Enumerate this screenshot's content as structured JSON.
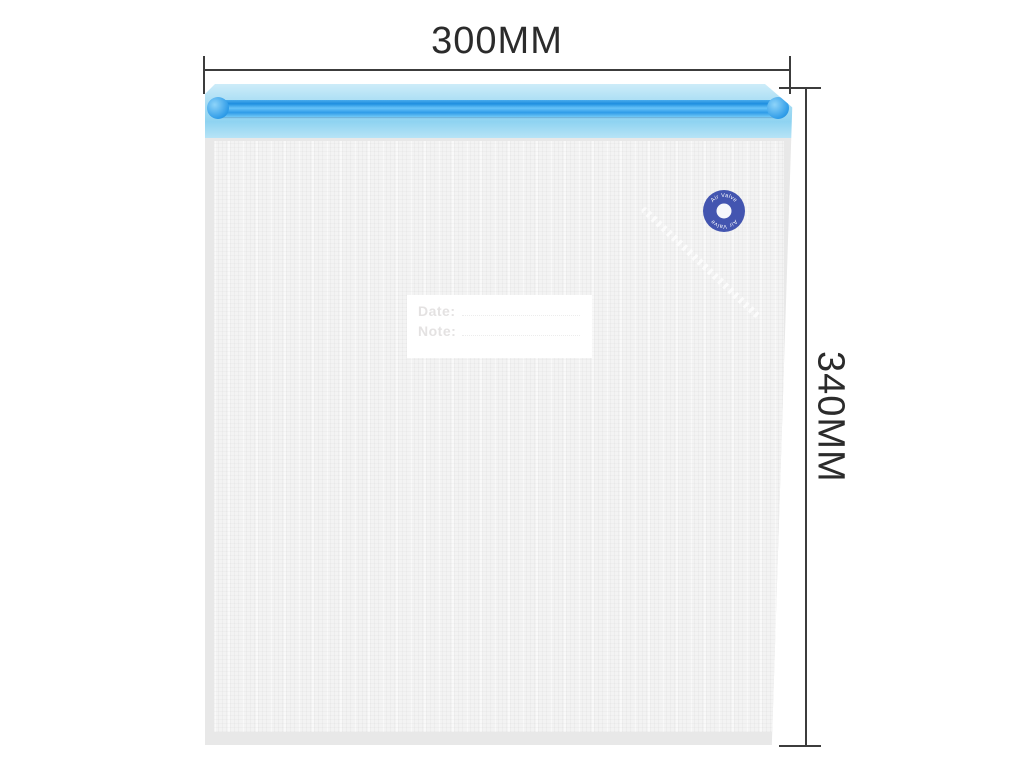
{
  "dimensions": {
    "width_label": "300MM",
    "height_label": "340MM"
  },
  "bag": {
    "valve": {
      "label_top": "Air Valve",
      "label_bottom": "Air Valve"
    },
    "tag": {
      "date_label": "Date:",
      "note_label": "Note:"
    }
  },
  "colors": {
    "background": "#ffffff",
    "dimension_line": "#3c3c3c",
    "dimension_text": "#2b2b2b",
    "zipper_strip": "#a8ddf4",
    "zipper_rail": "#2f9ce8",
    "bag_body": "#f3f3f3",
    "bag_frame": "#e8e8e8",
    "valve_blue": "#4355b0",
    "tag_text": "#e4e2e2"
  }
}
